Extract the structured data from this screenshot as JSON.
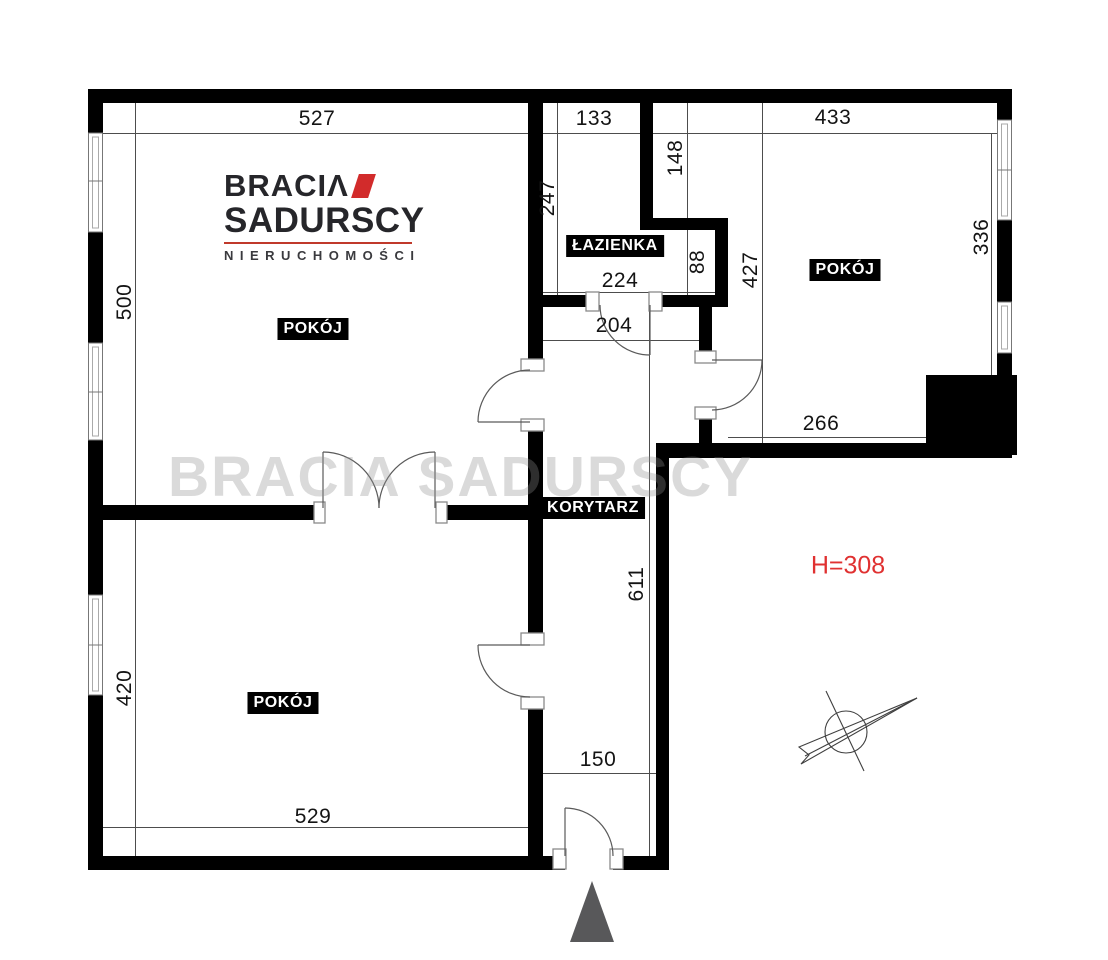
{
  "brand": {
    "name_top": "BRACIΛ",
    "name_bottom": "SADURSCY",
    "tagline": "NIERUCHOMOŚCI"
  },
  "watermark_text": "BRACIA SADURSCY",
  "rooms": {
    "top_left": "POKÓJ",
    "right": "POKÓJ",
    "bottom_left": "POKÓJ",
    "bathroom": "ŁAZIENKA",
    "corridor": "KORYTARZ"
  },
  "annotations": {
    "ceiling_height": "H=308"
  },
  "dimensions_cm": {
    "d527": "527",
    "d133": "133",
    "d433": "433",
    "d500": "500",
    "d247": "247",
    "d148": "148",
    "d336": "336",
    "d88": "88",
    "d224": "224",
    "d427": "427",
    "d204": "204",
    "d266": "266",
    "d611": "611",
    "d420": "420",
    "d150": "150",
    "d529": "529"
  },
  "colors": {
    "wall": "#000000",
    "brand_red": "#d22b2b",
    "height_red": "#e03131",
    "dim_line": "#4d4d4d"
  }
}
